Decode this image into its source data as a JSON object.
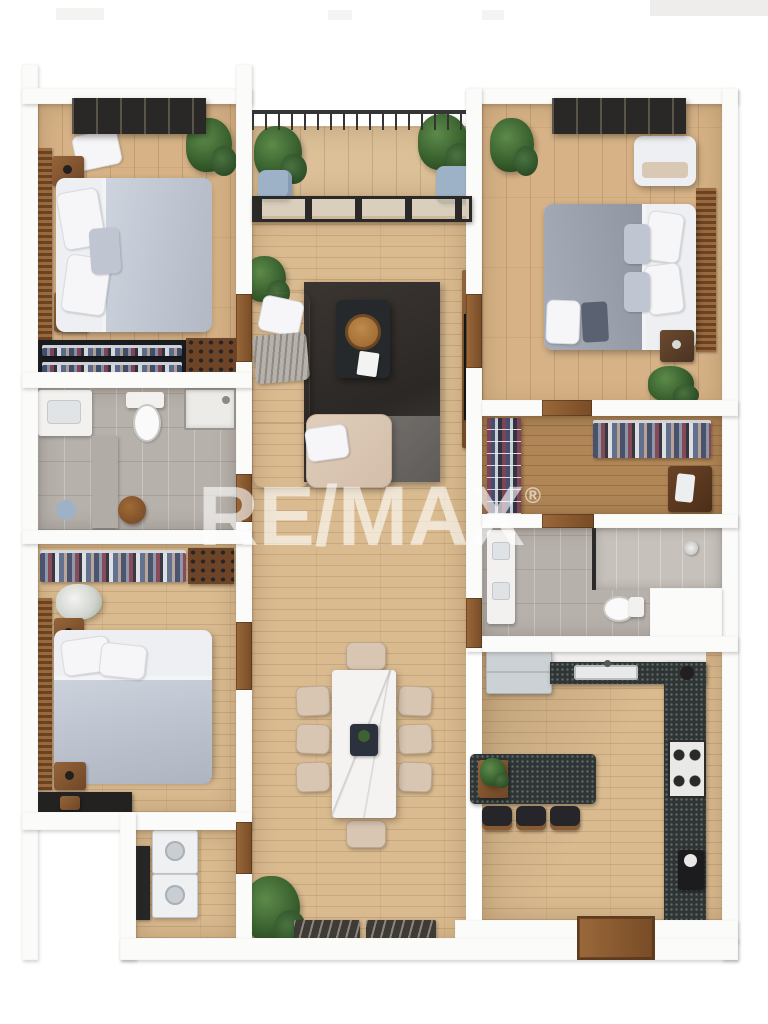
{
  "watermark": {
    "brand": "RE/MAX",
    "registered_symbol": "®"
  },
  "scene": {
    "type": "3d-floor-plan-render",
    "description": "Top-down 3D rendering of a three-bedroom apartment with central living area, balcony, two bathrooms, walk-in closet, laundry and open kitchen",
    "rooms": [
      {
        "name": "Bedroom 1 (top left)",
        "furniture": [
          "double bed with gray duvet",
          "two wooden nightstands with lamps",
          "louvered wardrobe wall",
          "folded-clothes shelf",
          "shoe shelf",
          "potted plant",
          "slatted pergola"
        ]
      },
      {
        "name": "Balcony",
        "furniture": [
          "metal railing",
          "two potted plants",
          "blue floor cushions",
          "sliding glass door"
        ]
      },
      {
        "name": "Bedroom 2 (top right)",
        "furniture": [
          "double bed with gray duvet",
          "bench with linens",
          "wooden nightstand with lamp",
          "louvered headboard wall",
          "two potted plants",
          "slatted pergola"
        ]
      },
      {
        "name": "Living room",
        "furniture": [
          "beige L-shaped sectional sofa",
          "white throw pillows",
          "gray fringed throw",
          "two-tone charcoal rug",
          "black coffee table with round wooden tray and magazine",
          "media wall with TV",
          "potted plant"
        ]
      },
      {
        "name": "Bathroom 1",
        "furniture": [
          "vanity",
          "toilet",
          "shower tray",
          "storage cabinet",
          "wooden stool",
          "round blue mat"
        ]
      },
      {
        "name": "Walk-in closet",
        "furniture": [
          "shoe rack",
          "hanging clothes rail",
          "dark wood dresser"
        ]
      },
      {
        "name": "Bathroom 2",
        "furniture": [
          "vanity with two sinks",
          "glass walk-in shower",
          "toilet",
          "wall-mounted shower head"
        ]
      },
      {
        "name": "Bedroom 3 (bottom left)",
        "furniture": [
          "double bed with gray duvet",
          "two wooden nightstands",
          "open hanging rail with clothes",
          "shoe shelf",
          "vase with white flowers",
          "dark TV console"
        ]
      },
      {
        "name": "Laundry room",
        "furniture": [
          "stacked washer and dryer",
          "dark shelving unit"
        ]
      },
      {
        "name": "Dining area",
        "furniture": [
          "white marble dining table",
          "eight beige chairs",
          "dark centerpiece"
        ]
      },
      {
        "name": "Kitchen",
        "furniture": [
          "refrigerator",
          "dark stone counters",
          "sink with faucet",
          "four-burner gas cooktop",
          "kitchen island with plant",
          "three black bar stools",
          "coffee machine",
          "kettle"
        ]
      },
      {
        "name": "Entry",
        "furniture": [
          "wooden threshold",
          "two patterned doormats",
          "potted plant"
        ]
      }
    ],
    "palette": {
      "background": "#ffffff",
      "wall": "#fbfbf9",
      "wood_floor": "#d6b286",
      "corridor_wood": "#dabb90",
      "closet_wood": "#b08657",
      "bathroom_tile": "#b7b1ab",
      "counter_stone": "#2e3534",
      "rug_dark": "#3a3531",
      "rug_light": "#6f6b67",
      "sofa_beige": "#d9c6b3",
      "bedding_gray": "#c3c9d4",
      "wood_furniture": "#8a5a33",
      "plant_green": "#3c6231",
      "appliance_gray": "#ccd1d5",
      "cushion_blue": "#9db1c7"
    }
  }
}
